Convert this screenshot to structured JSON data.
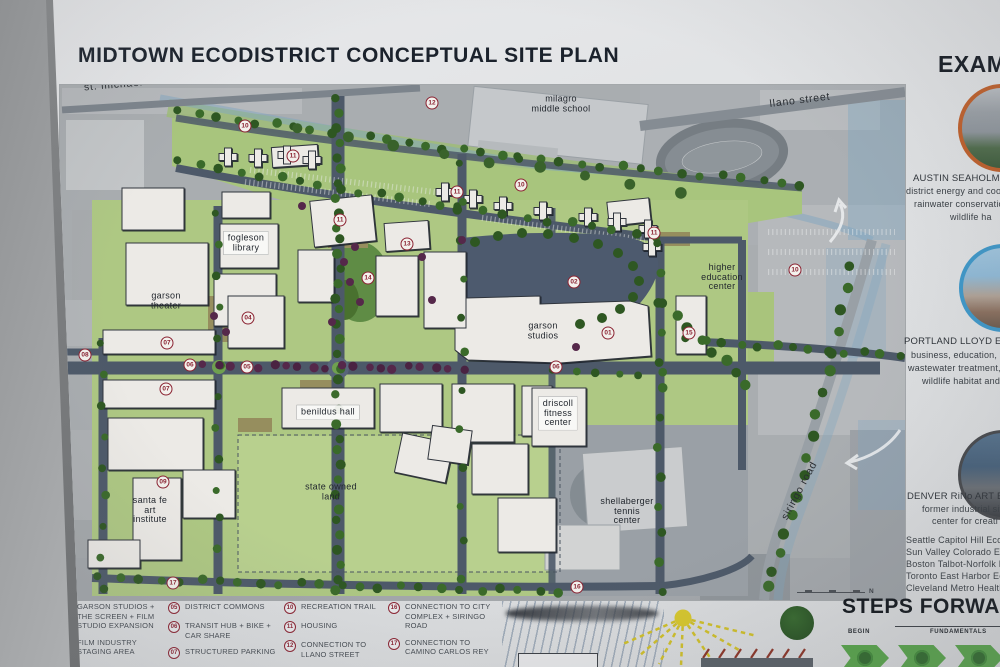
{
  "poster": {
    "title": "MIDTOWN ECODISTRICT CONCEPTUAL SITE PLAN"
  },
  "map": {
    "labels": [
      {
        "text": "st. michael's drive",
        "x": 133,
        "y": 84,
        "rot": -5,
        "style": "street"
      },
      {
        "text": "llano street",
        "x": 800,
        "y": 101,
        "rot": -7,
        "style": "street"
      },
      {
        "text": "siringo road",
        "x": 800,
        "y": 491,
        "rot": -62,
        "style": "street"
      },
      {
        "text": "milagro\nmiddle school",
        "x": 561,
        "y": 104
      },
      {
        "text": "fogleson\nlibrary",
        "x": 246,
        "y": 243,
        "plaque": true
      },
      {
        "text": "garson\ntheater",
        "x": 166,
        "y": 301
      },
      {
        "text": "garson\nstudios",
        "x": 543,
        "y": 331
      },
      {
        "text": "higher\neducation\ncenter",
        "x": 722,
        "y": 277
      },
      {
        "text": "benildus hall",
        "x": 328,
        "y": 412,
        "plaque": true
      },
      {
        "text": "driscoll\nfitness\ncenter",
        "x": 558,
        "y": 413,
        "plaque": true
      },
      {
        "text": "state owned\nland",
        "x": 331,
        "y": 492
      },
      {
        "text": "santa fe\nart\ninstitute",
        "x": 150,
        "y": 510
      },
      {
        "text": "shellaberger\ntennis\ncenter",
        "x": 627,
        "y": 511
      }
    ],
    "markers": [
      {
        "n": "10",
        "x": 245,
        "y": 126
      },
      {
        "n": "11",
        "x": 293,
        "y": 156
      },
      {
        "n": "12",
        "x": 432,
        "y": 103
      },
      {
        "n": "11",
        "x": 457,
        "y": 192
      },
      {
        "n": "10",
        "x": 521,
        "y": 185
      },
      {
        "n": "11",
        "x": 654,
        "y": 233
      },
      {
        "n": "10",
        "x": 795,
        "y": 270
      },
      {
        "n": "11",
        "x": 340,
        "y": 220
      },
      {
        "n": "13",
        "x": 407,
        "y": 244
      },
      {
        "n": "14",
        "x": 368,
        "y": 278
      },
      {
        "n": "04",
        "x": 248,
        "y": 318
      },
      {
        "n": "07",
        "x": 167,
        "y": 343
      },
      {
        "n": "08",
        "x": 85,
        "y": 355
      },
      {
        "n": "06",
        "x": 190,
        "y": 365
      },
      {
        "n": "05",
        "x": 247,
        "y": 367
      },
      {
        "n": "07",
        "x": 166,
        "y": 389
      },
      {
        "n": "02",
        "x": 574,
        "y": 282
      },
      {
        "n": "01",
        "x": 608,
        "y": 333
      },
      {
        "n": "15",
        "x": 689,
        "y": 333
      },
      {
        "n": "06",
        "x": 556,
        "y": 367
      },
      {
        "n": "09",
        "x": 163,
        "y": 482
      },
      {
        "n": "17",
        "x": 173,
        "y": 583
      },
      {
        "n": "16",
        "x": 577,
        "y": 587
      }
    ],
    "compass_n": "N"
  },
  "legend": {
    "columns": [
      [
        {
          "n": "01",
          "t": "GARSON STUDIOS + THE SCREEN + FILM STUDIO EXPANSION"
        },
        {
          "n": "02",
          "t": "FILM INDUSTRY STAGING AREA"
        }
      ],
      [
        {
          "n": "05",
          "t": "DISTRICT COMMONS"
        },
        {
          "n": "06",
          "t": "TRANSIT HUB + BIKE + CAR SHARE"
        },
        {
          "n": "07",
          "t": "STRUCTURED PARKING"
        }
      ],
      [
        {
          "n": "10",
          "t": "RECREATION TRAIL"
        },
        {
          "n": "11",
          "t": "HOUSING"
        },
        {
          "n": "12",
          "t": "CONNECTION TO LLANO STREET"
        }
      ],
      [
        {
          "n": "16",
          "t": "CONNECTION TO CITY COMPLEX + SIRINGO ROAD"
        },
        {
          "n": "17",
          "t": "CONNECTION TO CAMINO CARLOS REY"
        }
      ]
    ]
  },
  "steps": {
    "title": "STEPS FORWARD",
    "begin": "BEGIN",
    "fundamentals": "FUNDAMENTALS"
  },
  "sidebar": {
    "heading": "EXAMPLES",
    "examples": [
      {
        "ring_color": "#bf5f2a",
        "lines": [
          {
            "t": "AUSTIN SEAHOLM DI",
            "x": 913,
            "y": 178,
            "caps": true
          },
          {
            "t": "district energy and coo",
            "x": 906,
            "y": 191
          },
          {
            "t": "rainwater conservatio",
            "x": 914,
            "y": 204
          },
          {
            "t": "wildlife ha",
            "x": 950,
            "y": 217
          }
        ]
      },
      {
        "ring_color": "#3e97c8",
        "lines": [
          {
            "t": "PORTLAND LLOYD ECO",
            "x": 904,
            "y": 341,
            "caps": true
          },
          {
            "t": "business, education, mi",
            "x": 911,
            "y": 355
          },
          {
            "t": "wastewater treatment,",
            "x": 908,
            "y": 368
          },
          {
            "t": "wildlife habitat and",
            "x": 922,
            "y": 381
          }
        ]
      },
      {
        "ring_color": "#46484c",
        "lines": [
          {
            "t": "DENVER RiNo ART ECO",
            "x": 907,
            "y": 496,
            "caps": true
          },
          {
            "t": "former industrial site",
            "x": 922,
            "y": 509
          },
          {
            "t": "center for creati",
            "x": 932,
            "y": 521
          }
        ]
      }
    ],
    "list": [
      {
        "t": "Seattle Capitol Hill Eco",
        "x": 906,
        "y": 540
      },
      {
        "t": "Sun Valley Colorado Ec",
        "x": 906,
        "y": 552
      },
      {
        "t": "Boston Talbot-Norfolk E",
        "x": 906,
        "y": 564
      },
      {
        "t": "Toronto East Harbor Ec",
        "x": 906,
        "y": 576
      },
      {
        "t": "Cleveland Metro Health",
        "x": 906,
        "y": 588
      }
    ]
  },
  "colors": {
    "marker_ring": "#8b2332",
    "road": "#4d5969",
    "campus_green": "#aec883",
    "staging_blue": "#4d5a6e",
    "tree_green": "#2e5722",
    "tree_purple": "#55284a",
    "arrow_green": "#55a348",
    "sun_yellow": "#d6c62c",
    "creek_blue": "#7fa6c0"
  }
}
